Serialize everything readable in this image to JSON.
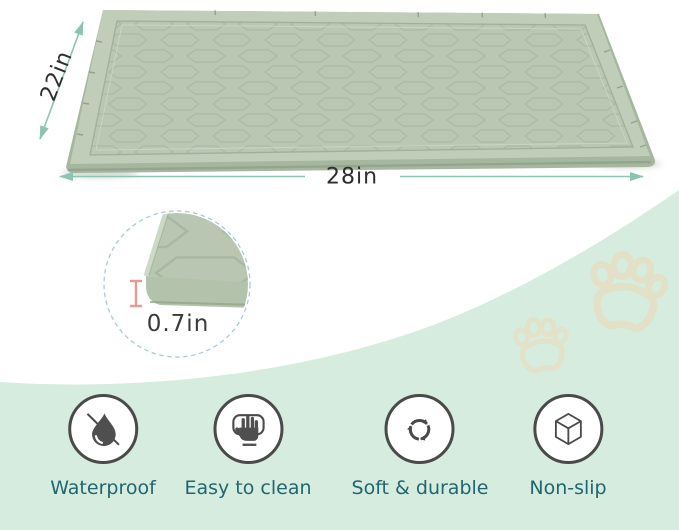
{
  "dimensions": {
    "depth": "22in",
    "width": "28in",
    "thickness": "0.7in"
  },
  "features": [
    {
      "label": "Waterproof",
      "icon": "water-drop-crossed-icon"
    },
    {
      "label": "Easy to clean",
      "icon": "hand-wipe-icon"
    },
    {
      "label": "Soft & durable",
      "icon": "recycle-arrows-icon"
    },
    {
      "label": "Non-slip",
      "icon": "cube-icon"
    }
  ],
  "colors": {
    "mat_surface": "#bac8b3",
    "mat_rim": "#c0cdb9",
    "mat_wall": "#a6b79f",
    "background_mint": "#d6ecdf",
    "dimension_arrow": "#8cc3b1",
    "dimension_text": "#2e2e2e",
    "feature_label_text": "#20666e",
    "icon_gray": "#4a4a4a",
    "thickness_marker_red": "#e89a92",
    "detail_circle_dash": "#a8cbd7",
    "paw_print": "#e6dfc4"
  }
}
